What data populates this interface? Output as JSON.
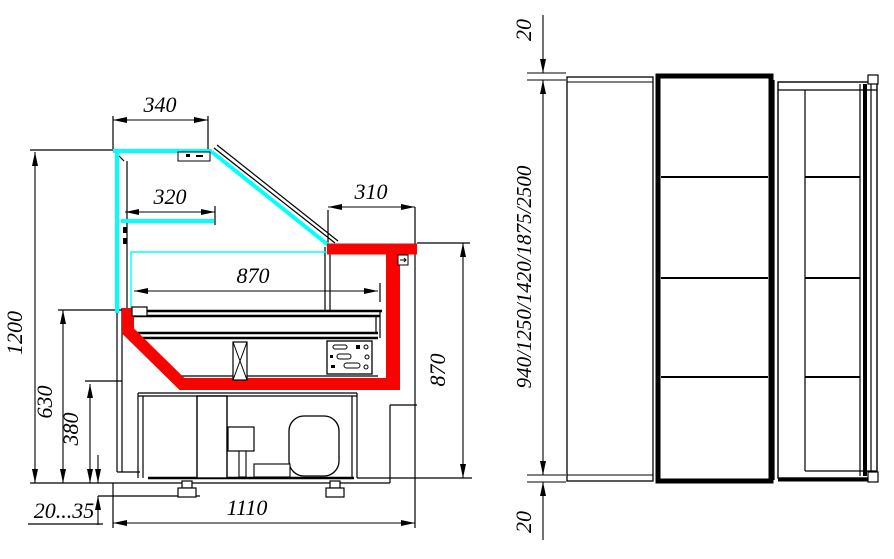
{
  "drawing": {
    "type": "technical-drawing",
    "views": {
      "left": "side-section-view",
      "right": "front-view"
    },
    "colors": {
      "glass": "#00ffff",
      "accent": "#f80400",
      "line": "#000000",
      "background": "#ffffff"
    },
    "side_view": {
      "dims": {
        "canopy_width": "340",
        "shelf_width": "320",
        "worktop_width": "310",
        "display_depth": "870",
        "overall_height": "1200",
        "deck_height": "630",
        "base_height": "380",
        "leg_adjust": "20...35",
        "overall_depth": "1110",
        "service_height": "870"
      }
    },
    "front_view": {
      "dims": {
        "top_clearance": "20",
        "lengths": "940/1250/1420/1875/2500",
        "bottom_clearance": "20"
      }
    }
  }
}
